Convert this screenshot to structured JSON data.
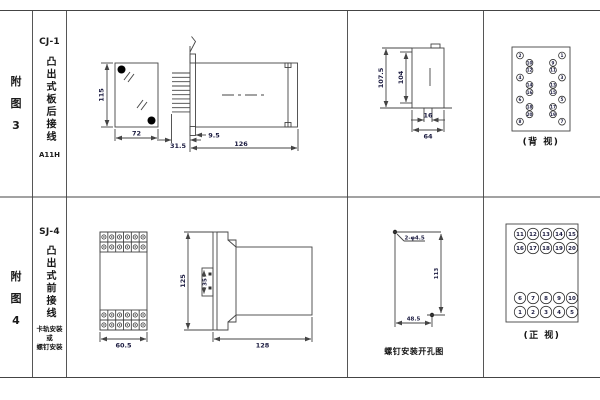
{
  "fig3": {
    "chars": [
      "附",
      "图",
      "3"
    ]
  },
  "fig4": {
    "chars": [
      "附",
      "图",
      "4"
    ]
  },
  "cj1": {
    "model": "CJ-1",
    "mount_type": "凸出式板后接线",
    "code": "A11H",
    "dims": {
      "front_height": "115",
      "front_width": "72",
      "pin_depth": "31.5",
      "flange": "9.5",
      "body_length": "126",
      "cutout_total_height": "107.5",
      "cutout_height": "104",
      "slot_width": "16",
      "cutout_width": "64"
    },
    "back_view": {
      "caption": "(背 视)",
      "left_outer": [
        "2",
        "4",
        "6",
        "8"
      ],
      "left_inner": [
        "10",
        "12",
        "14",
        "16",
        "18",
        "20"
      ],
      "right_inner": [
        "9",
        "11",
        "13",
        "15",
        "17",
        "19"
      ],
      "right_outer": [
        "1",
        "3",
        "5",
        "7"
      ]
    }
  },
  "sj4": {
    "model": "SJ-4",
    "mount_type": "凸出式前接线",
    "mount_notes": [
      "卡轨安装",
      "或",
      "螺钉安装"
    ],
    "dims": {
      "front_width": "60.5",
      "height": "125",
      "rail_width": "35",
      "body_length": "128",
      "hole_label": "2-φ4.5",
      "hole_spacing_v": "113",
      "hole_spacing_h": "48.5"
    },
    "hole_caption": "螺钉安装开孔图",
    "front_view": {
      "caption": "(正 视)",
      "rows": [
        [
          "11",
          "12",
          "13",
          "14",
          "15"
        ],
        [
          "16",
          "17",
          "18",
          "19",
          "20"
        ],
        [
          "6",
          "7",
          "8",
          "9",
          "10"
        ],
        [
          "1",
          "2",
          "3",
          "4",
          "5"
        ]
      ]
    }
  }
}
